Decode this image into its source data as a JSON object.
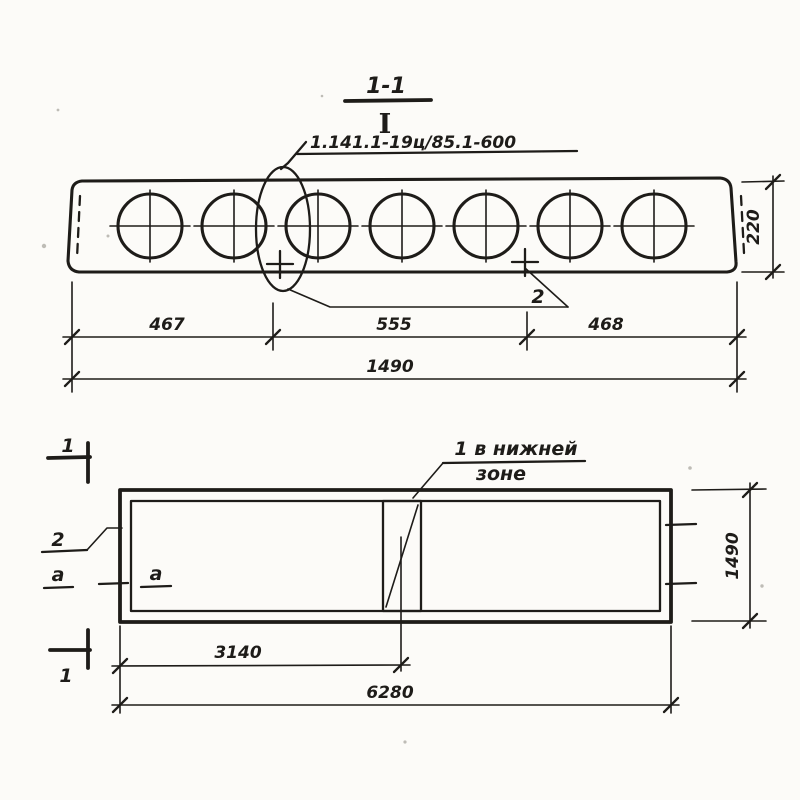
{
  "drawing": {
    "ink_color": "#1e1c19",
    "paper_color": "#fcfbf8",
    "section_view": {
      "title": "1-1",
      "i_symbol": "I",
      "series_label": "1.141.1-19ц/85.1-600",
      "callout_mark": "2",
      "dim_segments": [
        "467",
        "555",
        "468"
      ],
      "dim_total": "1490",
      "dim_height": "220",
      "hole_count": 7
    },
    "plan_view": {
      "section_marker_top": "1",
      "section_marker_bottom": "1",
      "edge_callout": "2",
      "section_letter_left": "a",
      "section_letter_inner": "a",
      "note_line1": "1 в нижней",
      "note_line2": "зоне",
      "dim_to_center": "3140",
      "dim_length": "6280",
      "dim_width": "1490"
    }
  }
}
